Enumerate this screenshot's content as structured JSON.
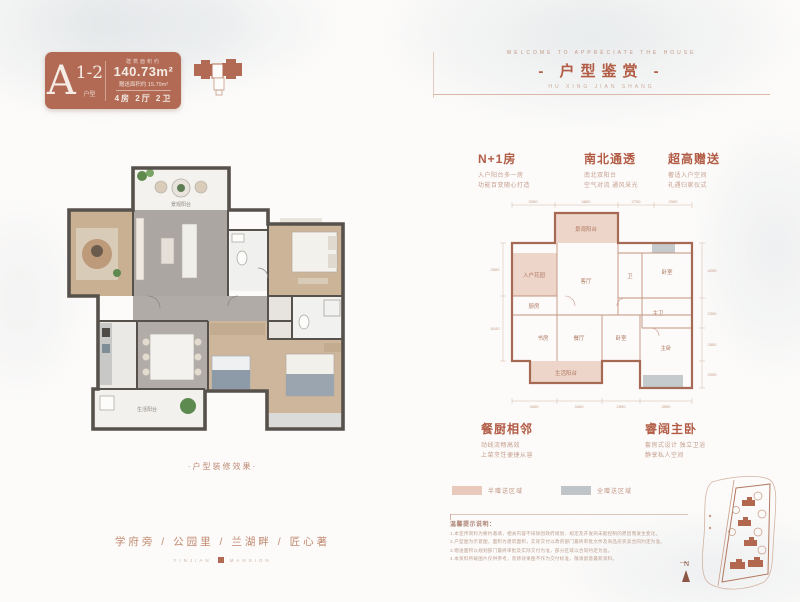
{
  "colors": {
    "accent": "#b25c45",
    "badge_bg": "#b26a54",
    "wall_dark": "#57514c",
    "line_wall": "#a66a54",
    "pink_fill": "#eed5c9",
    "gray_fill": "#c5cacd"
  },
  "badge": {
    "letter": "A",
    "sup": "1-2",
    "sub": "户型",
    "area_label": "建筑面积约",
    "area_value": "140.73m²",
    "gift_line": "赠送面积约 15.79m²",
    "rooms": "4房 2厅 2卫"
  },
  "header": {
    "eyebrow": "WELCOME TO APPRECIATE THE HOUSE",
    "title": "- 户型鉴赏 -",
    "subtitle": "HU XING JIAN SHANG"
  },
  "left_plan": {
    "balcony_label": "景观阳台",
    "service_label": "生活阳台",
    "caption": "·户型装修效果·"
  },
  "callouts_top": [
    {
      "title": "N+1房",
      "line1": "入户阳台多一房",
      "line2": "功能百变随心打造"
    },
    {
      "title": "南北通透",
      "line1": "南北双阳台",
      "line2": "空气对流 通风采光"
    },
    {
      "title": "超高赠送",
      "line1": "奢适入户空间",
      "line2": "礼遇归家仪式"
    }
  ],
  "callouts_bottom": [
    {
      "title": "餐厨相邻",
      "line1": "动线流畅高效",
      "line2": "上菜烹饪便捷从容"
    },
    {
      "title": "睿阔主卧",
      "line1": "套房式设计 独立卫浴",
      "line2": "静享私人空间"
    }
  ],
  "lineplan": {
    "rooms": {
      "balcony_top": "景观阳台",
      "entry": "入户花园",
      "living": "客厅",
      "bath1": "卫",
      "bed1": "卧室",
      "bath2": "主卫",
      "kitchen": "厨房",
      "study": "书房",
      "dining": "餐厅",
      "bed2": "卧室",
      "master": "主卧",
      "service": "生活阳台"
    },
    "dims_top": [
      "3300",
      "4800",
      "2700",
      "2900"
    ],
    "dims_bottom": [
      "3400",
      "3400",
      "2900",
      "3900"
    ],
    "dims_right": [
      "4200",
      "2300",
      "2500",
      "2000"
    ],
    "dims_left": [
      "3300",
      "5100"
    ]
  },
  "legend": [
    {
      "label": "半赠送区域"
    },
    {
      "label": "全赠送区域"
    }
  ],
  "notes": {
    "heading": "温馨提示说明：",
    "items": [
      "1.本宣传资料为要约邀请，相关内容不排除因政府规划、规定及开发商未能控制的原因而发生变化。",
      "2.户型图为示意图，面积为建筑面积，实际交付以政府部门最终审批文件及商品房买卖合同约定为准。",
      "3.赠送面积以规划部门最终审批及实际交付为准，部分区域以合同约定为准。",
      "4.本资料所载图片仅供参考，装修效果图不作为交付标准，敬请留意最新资料。"
    ]
  },
  "slogan": {
    "text": "学府旁 / 公园里 / 兰湖畔 / 匠心著",
    "brand_left": "YINJIAN",
    "brand_right": "MANSION"
  },
  "sitemap": {
    "north_label": "N"
  }
}
